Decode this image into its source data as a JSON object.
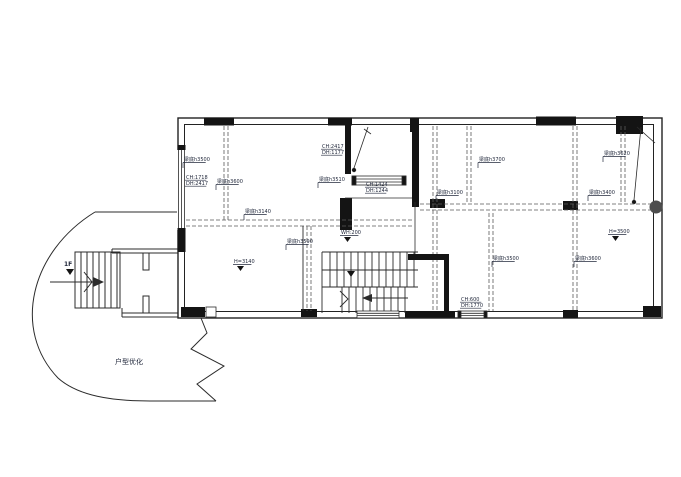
{
  "drawing": {
    "watermark": {
      "text": "户型优化",
      "x": 115,
      "y": 364,
      "color": "#5b4a8a"
    },
    "floor_label": {
      "text": "1F",
      "x": 64,
      "y": 266,
      "color": "#1d4ed8"
    },
    "line_color": "#2b2b2b",
    "dash_color": "#5a5a5a",
    "column_color": "#141414",
    "beam_labels": [
      {
        "text": "梁底h3500",
        "x": 184,
        "y": 161
      },
      {
        "text": "梁底h3600",
        "x": 217,
        "y": 183
      },
      {
        "text": "梁底h3140",
        "x": 245,
        "y": 213
      },
      {
        "text": "梁底h3510",
        "x": 319,
        "y": 181
      },
      {
        "text": "梁底h3590",
        "x": 287,
        "y": 243
      },
      {
        "text": "梁底h3700",
        "x": 479,
        "y": 161
      },
      {
        "text": "梁底h3100",
        "x": 437,
        "y": 194
      },
      {
        "text": "梁底h3500",
        "x": 493,
        "y": 260
      },
      {
        "text": "梁底h3620",
        "x": 604,
        "y": 155
      },
      {
        "text": "梁底h3400",
        "x": 589,
        "y": 194
      },
      {
        "text": "梁底h3600",
        "x": 575,
        "y": 260
      }
    ],
    "opening_labels": [
      {
        "line1": "CH:1718",
        "line2": "DH:2417",
        "x": 186,
        "y": 179
      },
      {
        "line1": "CH:2417",
        "line2": "DH:1177",
        "x": 322,
        "y": 148
      },
      {
        "line1": "CH:1424",
        "line2": "DH:1244",
        "x": 366,
        "y": 186
      },
      {
        "line1": "CH:600",
        "line2": "DH:1770",
        "x": 461,
        "y": 301
      }
    ],
    "level_labels": [
      {
        "text": "H=3140",
        "x": 234,
        "y": 263
      },
      {
        "text": "H=3500",
        "x": 609,
        "y": 233
      },
      {
        "text": "WH:200",
        "x": 341,
        "y": 234
      }
    ]
  }
}
